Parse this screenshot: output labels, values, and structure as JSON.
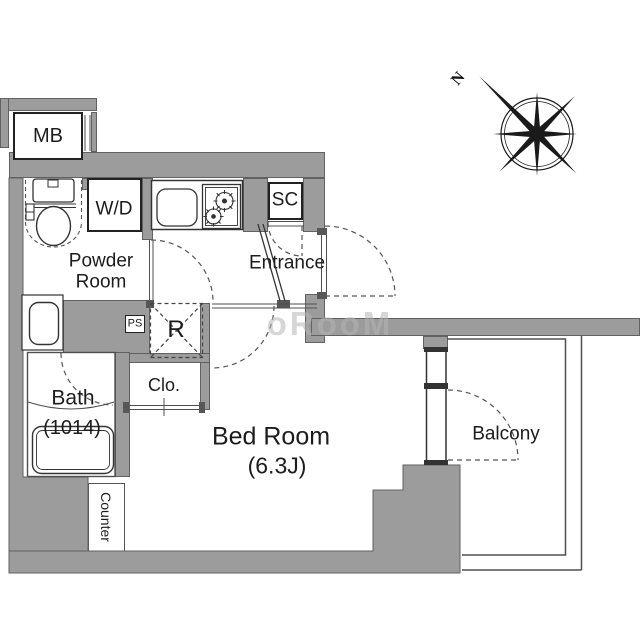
{
  "labels": {
    "mb": "MB",
    "wd": "W/D",
    "sc": "SC",
    "ps": "PS",
    "fridge": "R",
    "closet": "Clo.",
    "powder_line1": "Powder",
    "powder_line2": "Room",
    "entrance": "Entrance",
    "bath": "Bath",
    "bath_size": "(1014)",
    "bedroom": "Bed Room",
    "bedroom_size": "(6.3J)",
    "balcony": "Balcony",
    "counter": "Counter",
    "compass_north": "N"
  },
  "watermark": "oRooM",
  "colors": {
    "wall_fill": "#9c9c9c",
    "wall_outline": "#616161",
    "line": "#4f4f4f",
    "fixture_line": "#333333",
    "text": "#1c1c1c",
    "watermark": "rgba(180,180,180,0.55)"
  }
}
